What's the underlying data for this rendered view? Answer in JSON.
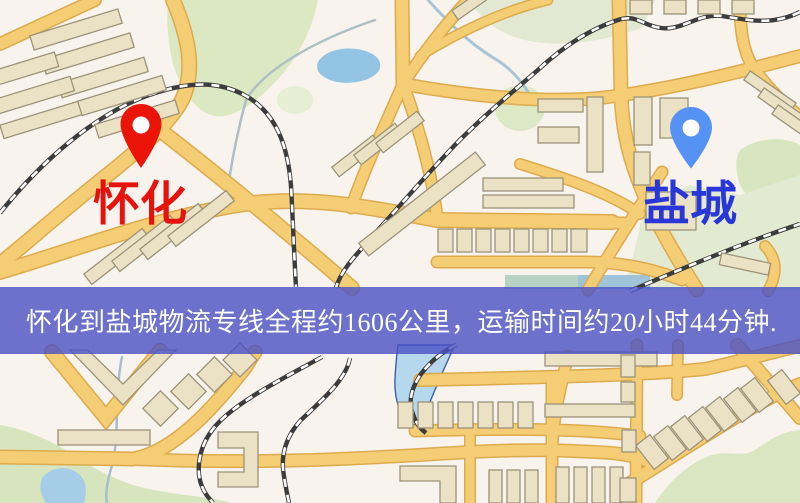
{
  "banner": {
    "text": "怀化到盐城物流专线全程约1606公里，运输时间约20小时44分钟.",
    "bg_color": "#4a50c4",
    "text_color": "#ffffff"
  },
  "route": {
    "origin": "怀化",
    "destination": "盐城",
    "distance": "约1606公里",
    "duration": "约20小时44分钟"
  },
  "markers": {
    "origin": {
      "label": "怀化",
      "label_color": "#e8120c",
      "pin_color": "#ea1408",
      "pin_hole_color": "#ffffff"
    },
    "destination": {
      "label": "盐城",
      "label_color": "#2936d8",
      "pin_color": "#5592f4",
      "pin_hole_color": "#ffffff"
    }
  },
  "map_colors": {
    "background": "#f8f3ec",
    "road_fill": "#f4cd74",
    "road_casing": "#ddab4e",
    "rail_dark": "#3c3c3c",
    "building": "#ebe2c6",
    "park_green": "#dce8c2",
    "water_blue": "#9ec8e6"
  }
}
